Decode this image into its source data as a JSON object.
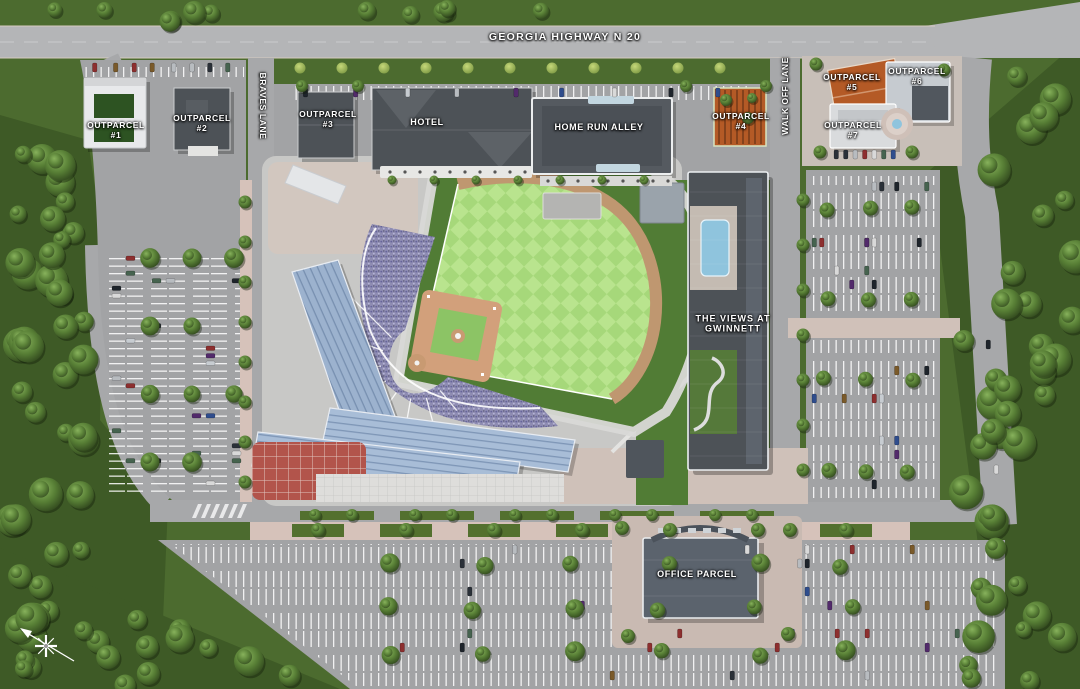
{
  "title": "Stadium mixed-use development site plan",
  "roads": {
    "highway": "GEORGIA HIGHWAY N 20",
    "braves_lane": "BRAVES LANE",
    "walk_off_lane": "WALK OFF LANE"
  },
  "parcels": {
    "outparcel1": {
      "name": "OUTPARCEL",
      "num": "#1"
    },
    "outparcel2": {
      "name": "OUTPARCEL",
      "num": "#2"
    },
    "outparcel3": {
      "name": "OUTPARCEL",
      "num": "#3"
    },
    "outparcel4": {
      "name": "OUTPARCEL",
      "num": "#4"
    },
    "outparcel5": {
      "name": "OUTPARCEL",
      "num": "#5"
    },
    "outparcel6": {
      "name": "OUTPARCEL",
      "num": "#6"
    },
    "outparcel7": {
      "name": "OUTPARCEL",
      "num": "#7"
    },
    "hotel": "HOTEL",
    "home_run_alley": "HOME RUN ALLEY",
    "views": {
      "line1": "THE  VIEWS  AT",
      "line2": "GWINNETT"
    },
    "office": "OFFICE PARCEL"
  },
  "colors": {
    "grass": "#4c6b2f",
    "forest": "#3e5a26",
    "road": "#a7a8aa",
    "highway": "#b4b5b7",
    "lot": "#a2a3a5",
    "concourse": "#c8c8c6",
    "outfield": "#a6d87a",
    "outfield_alt": "#b9e48e",
    "foul_grass": "#517c35",
    "warning_track": "#bf9770",
    "infield_dirt": "#d2a07b",
    "infield_grass": "#8cc465",
    "seats": "#8e8cb2",
    "roof_blue": "#a8bdd7",
    "brick_plaza": "#b2544b",
    "pool": "#8fc4dd",
    "building_dark": "#4d5257",
    "building_orange": "#b45a26",
    "sidewalk_pink": "#d6c2ba"
  }
}
